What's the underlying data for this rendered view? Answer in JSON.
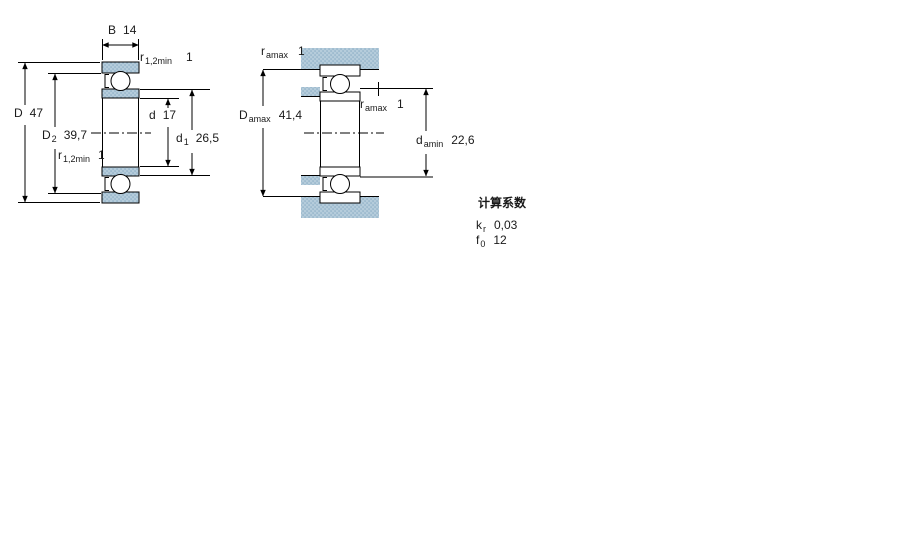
{
  "drawing": {
    "type": "bearing cross-section dimension drawing",
    "left_figure": {
      "labels": {
        "B": {
          "symbol": "B",
          "value": "14"
        },
        "r_top": {
          "symbol": "r",
          "subscript": "1,2min",
          "value": "1"
        },
        "D": {
          "symbol": "D",
          "value": "47"
        },
        "D2": {
          "symbol": "D",
          "subscript": "2",
          "value": "39,7"
        },
        "d": {
          "symbol": "d",
          "value": "17"
        },
        "d1": {
          "symbol": "d",
          "subscript": "1",
          "value": "26,5"
        },
        "r_bottom": {
          "symbol": "r",
          "subscript": "1,2min",
          "value": "1"
        }
      }
    },
    "right_figure": {
      "labels": {
        "ra_top": {
          "symbol": "r",
          "subscript": "amax",
          "value": "1"
        },
        "Da": {
          "symbol": "D",
          "subscript": "amax",
          "value": "41,4"
        },
        "ra_mid": {
          "symbol": "r",
          "subscript": "amax",
          "value": "1"
        },
        "da": {
          "symbol": "d",
          "subscript": "amin",
          "value": "22,6"
        }
      }
    },
    "calculation_factors": {
      "title": "计算系数",
      "rows": [
        {
          "symbol": "k",
          "subscript": "r",
          "value": "0,03"
        },
        {
          "symbol": "f",
          "subscript": "0",
          "value": "12"
        }
      ]
    },
    "colors": {
      "line": "#000000",
      "text": "#1a1a1a",
      "hatch_base": "#b5ccdb",
      "hatch_dot": "#87aac3",
      "background": "#ffffff"
    }
  }
}
